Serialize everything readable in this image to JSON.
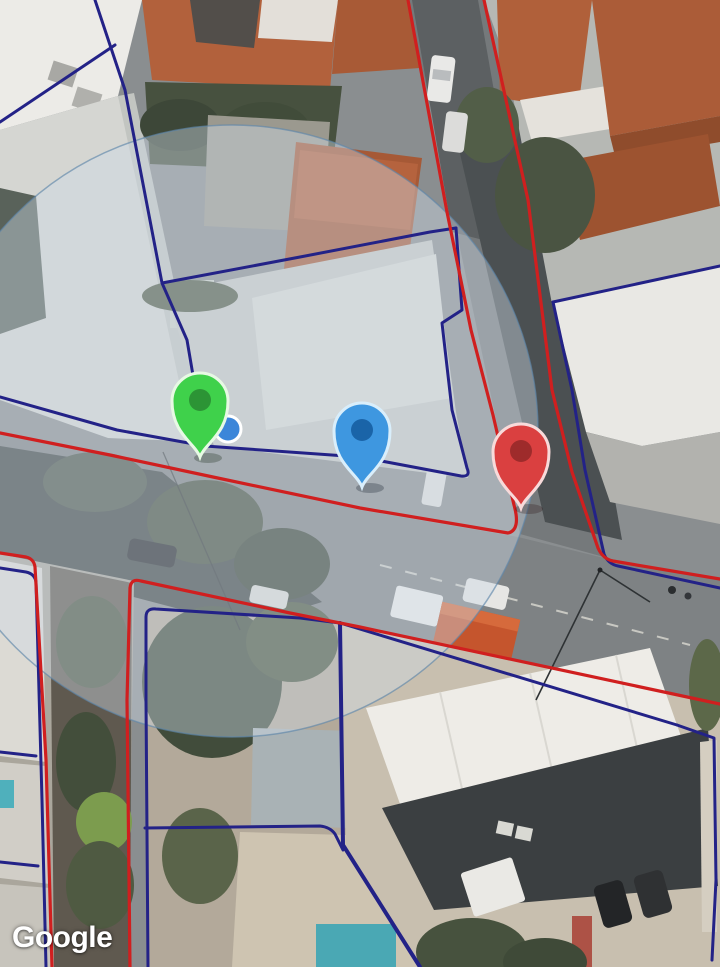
{
  "map": {
    "view_type": "satellite",
    "provider_watermark": "Google",
    "markers": [
      {
        "name": "green-pin",
        "icon": "map-pin-icon",
        "fill": "#3fd14b",
        "inner": "#2c9435",
        "stroke": "#e7f9e4",
        "tip_x": 200,
        "tip_y": 457
      },
      {
        "name": "blue-pin",
        "icon": "map-pin-icon",
        "fill": "#3e97e0",
        "inner": "#1a64a8",
        "stroke": "#d9eefb",
        "tip_x": 362,
        "tip_y": 487
      },
      {
        "name": "red-pin",
        "icon": "map-pin-icon",
        "fill": "#da4040",
        "inner": "#9e2b2b",
        "stroke": "#f8dada",
        "tip_x": 521,
        "tip_y": 508
      }
    ],
    "location_dot": {
      "icon": "current-location-dot-icon",
      "fill": "#3c86d9",
      "stroke": "#ffffff",
      "cx": 228,
      "cy": 429,
      "r": 13
    },
    "accuracy_circle": {
      "cx": 232,
      "cy": 431,
      "r": 306,
      "fill": "rgba(208,220,230,0.42)",
      "stroke": "rgba(95,135,170,0.65)"
    },
    "boundaries": {
      "parcel_navy": "#232287",
      "parcel_red": "#d01f1f"
    }
  }
}
